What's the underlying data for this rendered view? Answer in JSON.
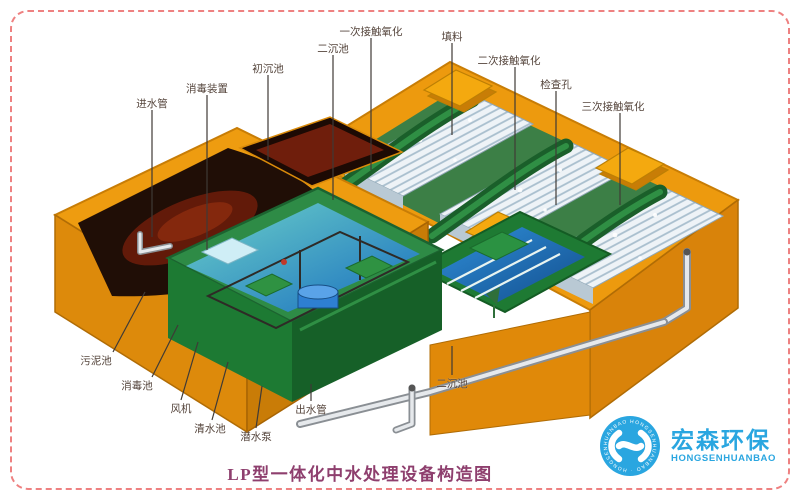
{
  "title": "LP型一体化中水处理设备构造图",
  "logo": {
    "name_cn": "宏森环保",
    "name_en": "HONGSENHUANBAO",
    "ring_text": "HONGSENHUANBAO · HONGSENHUANBAO ·"
  },
  "colors": {
    "border_pink": "#ee8181",
    "title_purple": "#8e3f6e",
    "logo_blue": "#2aa6e0",
    "tank_orange": "#ee9c10",
    "inner_green": "#1e7a33",
    "water_blue": "#1a6fc0",
    "packing_white": "#eef3f7",
    "cavity_dark": "#200e06"
  },
  "labels": {
    "inlet_pipe": "进水管",
    "disinfection_device": "消毒装置",
    "primary_sedimentation_tank": "初沉池",
    "secondary_sedimentation_tank_top": "二沉池",
    "first_contact_oxidation": "一次接触氧化",
    "packing_media": "填料",
    "second_contact_oxidation": "二次接触氧化",
    "inspection_hole": "检查孔",
    "third_contact_oxidation": "三次接触氧化",
    "sludge_tank": "污泥池",
    "disinfection_tank": "消毒池",
    "fan": "风机",
    "clear_water_tank": "清水池",
    "submersible_pump": "潜水泵",
    "outlet_pipe": "出水管",
    "secondary_sedimentation_tank_bottom": "二沉池"
  }
}
